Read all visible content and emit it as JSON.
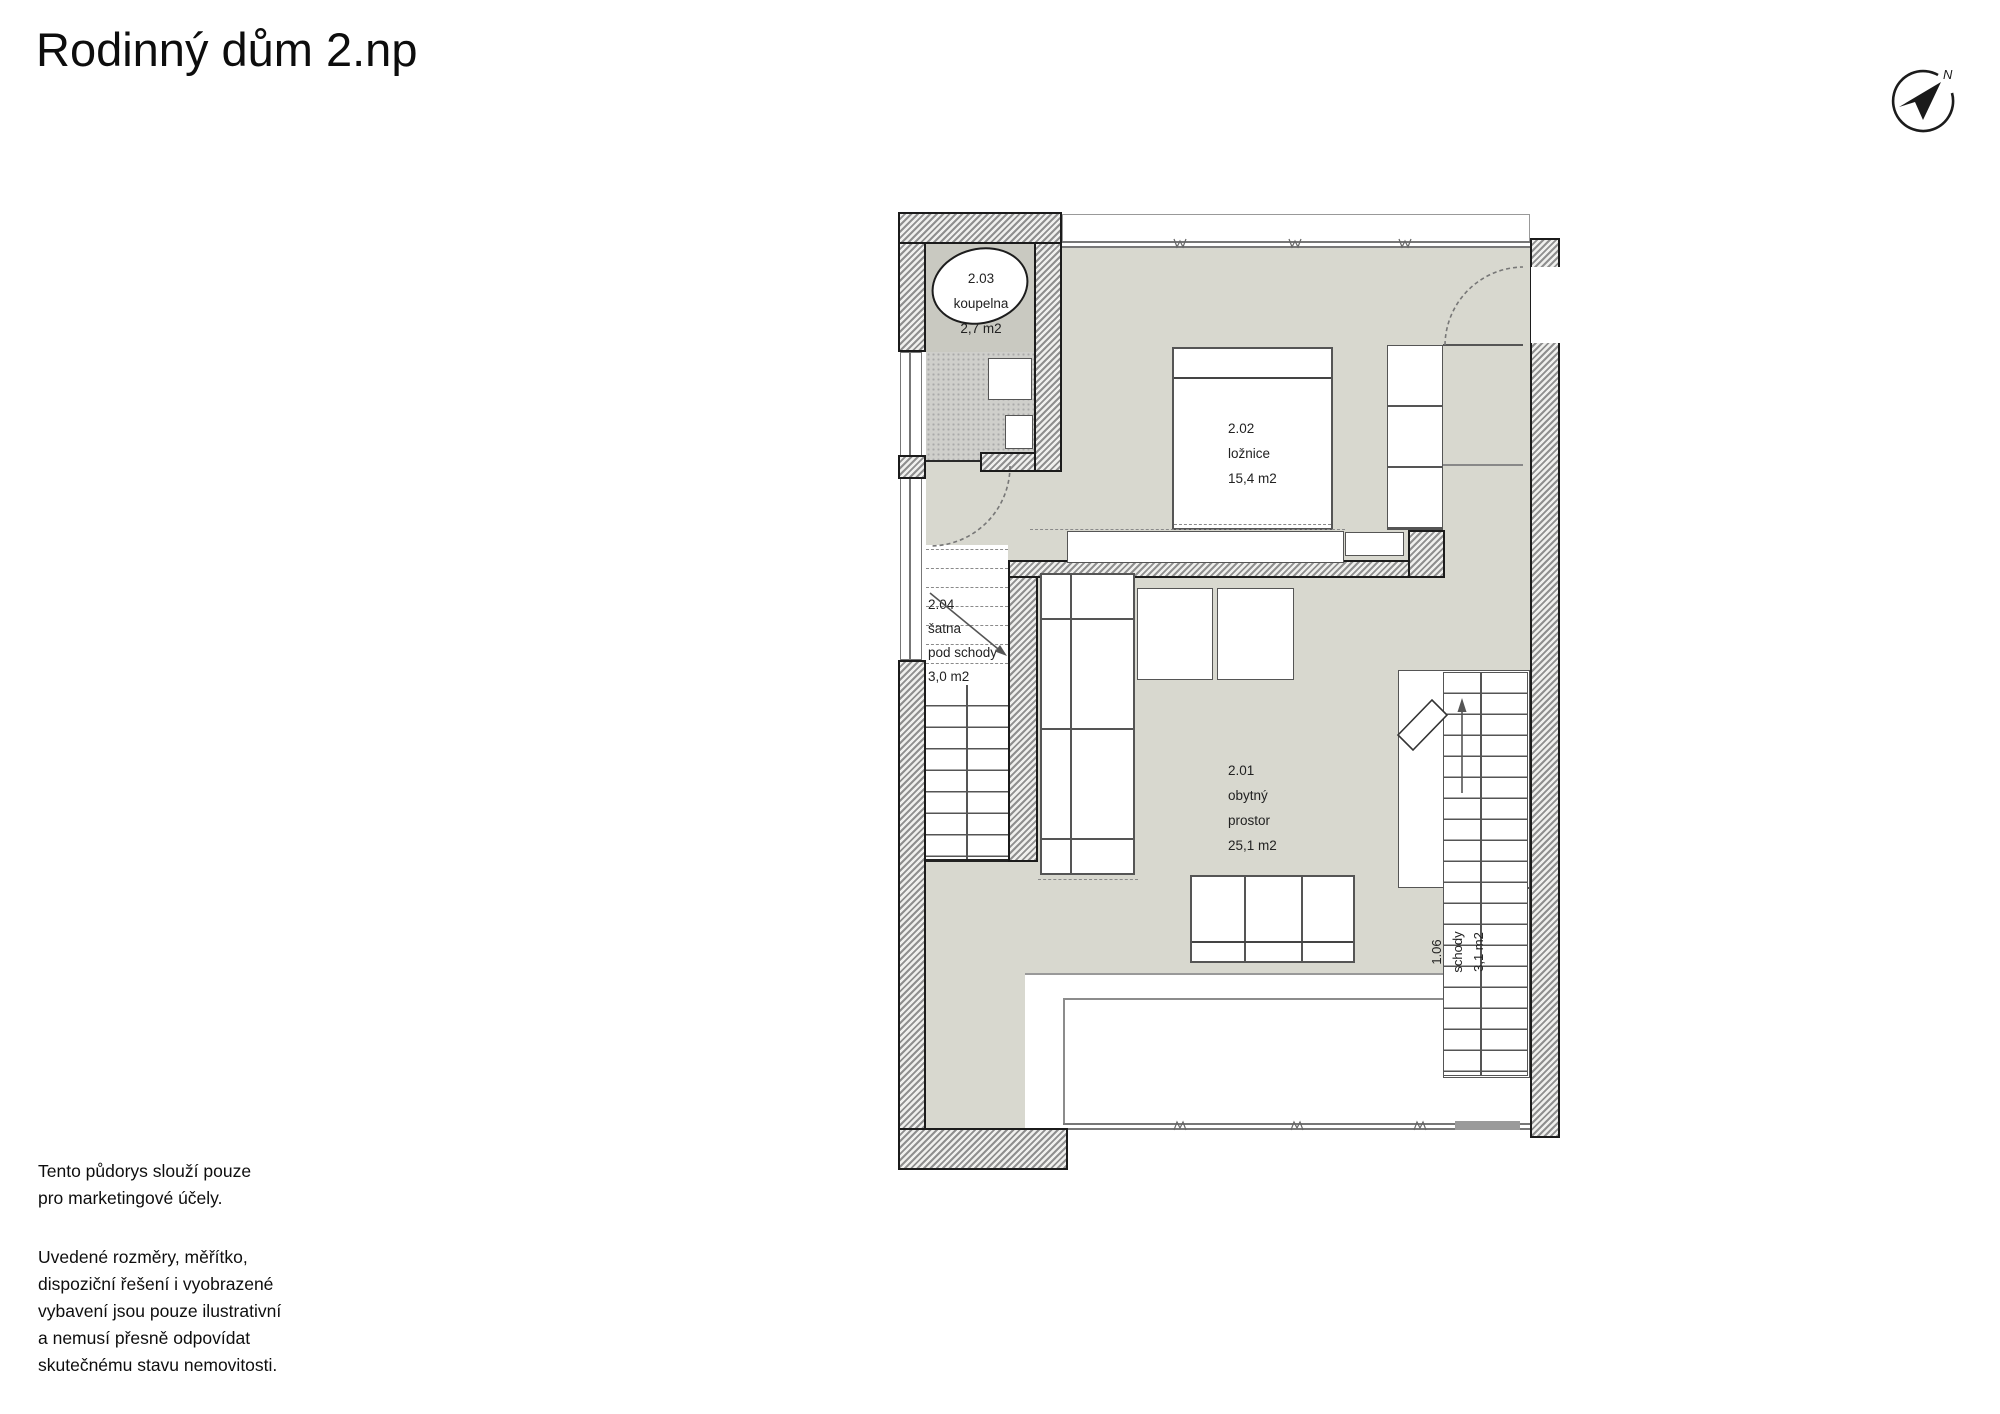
{
  "title": "Rodinný dům 2.np",
  "compass": {
    "north_label": "N"
  },
  "rooms": {
    "bathroom": {
      "lines": [
        "2.03",
        "koupelna",
        "2,7 m2"
      ]
    },
    "bedroom": {
      "lines": [
        "2.02",
        "ložnice",
        "15,4 m2"
      ]
    },
    "closet": {
      "lines": [
        "2.04",
        "šatna",
        "pod schody",
        "3,0 m2"
      ]
    },
    "living": {
      "lines": [
        "2.01",
        "obytný",
        "prostor",
        "25,1 m2"
      ]
    },
    "stairs": {
      "lines": [
        "1.06",
        "schody",
        "3,1 m2"
      ]
    }
  },
  "disclaimer": {
    "p1": "Tento půdorys slouží pouze\npro marketingové účely.",
    "p2": "Uvedené rozměry, měřítko,\ndispoziční řešení i vyobrazené\nvybavení jsou pouze ilustrativní\na nemusí přesně odpovídat\nskutečnému stavu nemovitosti."
  },
  "colors": {
    "floor": "#d8d8cf",
    "wall_ink": "#1b1b1b",
    "line": "#555555"
  }
}
